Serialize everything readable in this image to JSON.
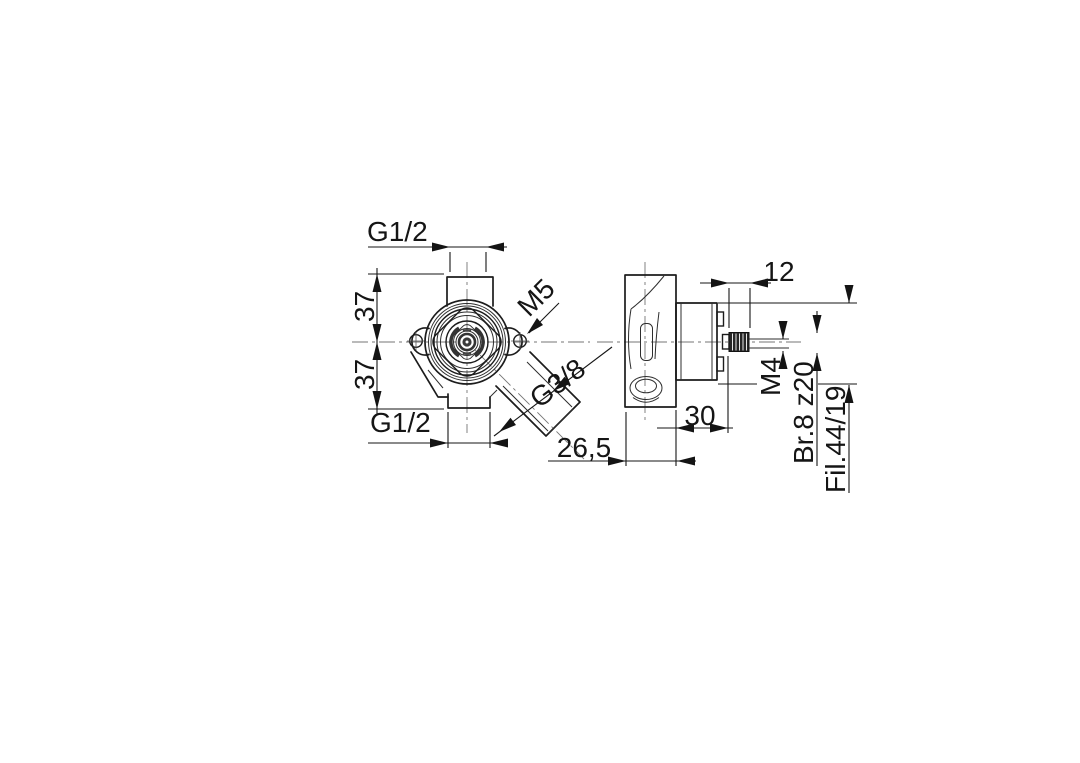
{
  "drawing": {
    "type": "orthographic-technical-drawing",
    "subject": "built-in valve body, front view and side section view",
    "views": {
      "front": {
        "thread_top": "G1/2",
        "offset_upper": "37",
        "offset_lower": "37",
        "thread_bottom": "G1/2",
        "screw_thread": "M5",
        "thread_outlet": "G3/8"
      },
      "side": {
        "spindle_length": "12",
        "cartridge_depth": "30",
        "body_depth": "26,5",
        "spindle_thread": "M4",
        "spline_spec": "Br.8 z20",
        "series_spec": "Fil.44/19"
      }
    },
    "colors": {
      "line": "#1c1c1c",
      "thin_line": "#2e2e2e",
      "centerline": "#767676",
      "background": "#ffffff"
    }
  }
}
